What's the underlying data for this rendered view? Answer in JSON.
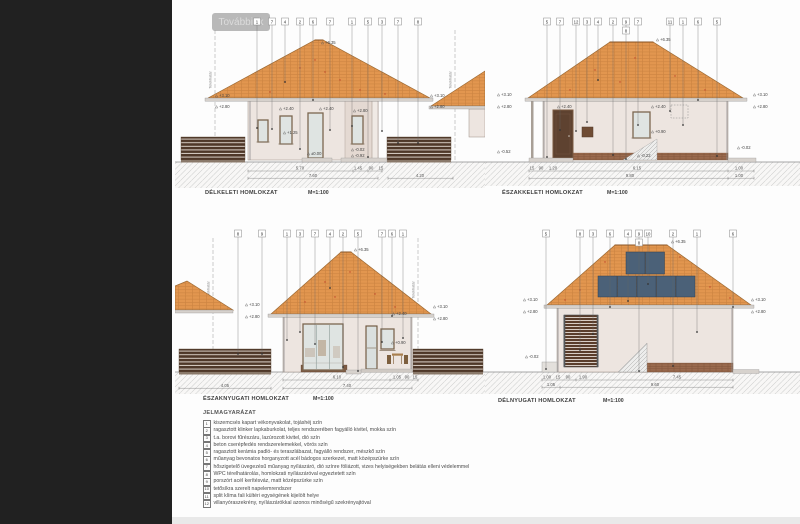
{
  "app": {
    "more_button": "Továbbiak"
  },
  "labels": {
    "boundary": "Telekhatár"
  },
  "colors": {
    "sidebar": "#212121",
    "page": "#fdfdfd",
    "roof_tile": "#e2964f",
    "wall": "#ede5e0",
    "fence_wood": "#4e3728",
    "klinker_plinth": "#9a6a4e",
    "solar_panel": "#4b6178",
    "ground_hatch": "#cdcdcd",
    "accent_red": "#c0452a"
  },
  "elevations": {
    "d1": {
      "title": "DÉLKELETI HOMLOKZAT",
      "scale": "M=1:100",
      "markers": [
        {
          "v": "1",
          "x": 82,
          "drop": 118
        },
        {
          "v": "7",
          "x": 97,
          "drop": 119
        },
        {
          "v": "4",
          "x": 110,
          "drop": 72
        },
        {
          "v": "2",
          "x": 125,
          "drop": 139
        },
        {
          "v": "6",
          "x": 138,
          "drop": 90
        },
        {
          "v": "7",
          "x": 155,
          "drop": 120
        },
        {
          "v": "1",
          "x": 177,
          "drop": 116
        },
        {
          "v": "5",
          "x": 193,
          "drop": 147
        },
        {
          "v": "3",
          "x": 207,
          "drop": 121
        },
        {
          "v": "7",
          "x": 223,
          "drop": 133
        },
        {
          "v": "8",
          "x": 243,
          "drop": 133
        }
      ],
      "levels": [
        {
          "v": "+6.35",
          "x": 150,
          "y": 34
        },
        {
          "v": "+3.10",
          "x": 44,
          "y": 87
        },
        {
          "v": "+2.80",
          "x": 44,
          "y": 98
        },
        {
          "v": "+2.40",
          "x": 108,
          "y": 100
        },
        {
          "v": "+2.40",
          "x": 148,
          "y": 100
        },
        {
          "v": "+2.80",
          "x": 182,
          "y": 102
        },
        {
          "v": "+1.25",
          "x": 112,
          "y": 124
        },
        {
          "v": "±0.00",
          "x": 136,
          "y": 145
        },
        {
          "v": "-0.02",
          "x": 180,
          "y": 141
        },
        {
          "v": "-0.92",
          "x": 180,
          "y": 147
        },
        {
          "v": "+3.10",
          "x": 259,
          "y": 87
        },
        {
          "v": "+2.80",
          "x": 259,
          "y": 98
        }
      ],
      "dims": [
        {
          "v": "5.70",
          "x": 125,
          "y": 159.5
        },
        {
          "v": "1.45",
          "x": 183,
          "y": 159.5
        },
        {
          "v": "90",
          "x": 196,
          "y": 159.5
        },
        {
          "v": "15",
          "x": 206,
          "y": 159.5
        },
        {
          "v": "7.60",
          "x": 138,
          "y": 166.8
        },
        {
          "v": "4.20",
          "x": 245,
          "y": 166.8
        }
      ]
    },
    "d2": {
      "title": "ÉSZAKKELETI HOMLOKZAT",
      "scale": "M=1:100",
      "markers": [
        {
          "v": "5",
          "x": 62,
          "drop": 147
        },
        {
          "v": "7",
          "x": 75,
          "drop": 120
        },
        {
          "v": "12",
          "x": 91,
          "drop": 121
        },
        {
          "v": "3",
          "x": 102,
          "drop": 112
        },
        {
          "v": "4",
          "x": 113,
          "drop": 70
        },
        {
          "v": "2",
          "x": 128,
          "drop": 145
        },
        {
          "v": "9",
          "x": 141,
          "drop": 149
        },
        {
          "v": "8",
          "x": 141,
          "y": 17
        },
        {
          "v": "7",
          "x": 153,
          "drop": 115
        },
        {
          "v": "11",
          "x": 185,
          "drop": 101
        },
        {
          "v": "1",
          "x": 198,
          "drop": 115
        },
        {
          "v": "6",
          "x": 213,
          "drop": 90
        },
        {
          "v": "5",
          "x": 232,
          "drop": 146
        }
      ],
      "levels": [
        {
          "v": "+6.35",
          "x": 175,
          "y": 31
        },
        {
          "v": "+3.10",
          "x": 16,
          "y": 86
        },
        {
          "v": "+2.80",
          "x": 16,
          "y": 98
        },
        {
          "v": "+2.40",
          "x": 76,
          "y": 98
        },
        {
          "v": "+2.40",
          "x": 170,
          "y": 98
        },
        {
          "v": "+0.90",
          "x": 170,
          "y": 123
        },
        {
          "v": "-0.52",
          "x": 16,
          "y": 143
        },
        {
          "v": "-0.22",
          "x": 156,
          "y": 147
        },
        {
          "v": "-0.02",
          "x": 256,
          "y": 139
        },
        {
          "v": "+3.10",
          "x": 272,
          "y": 86
        },
        {
          "v": "+2.80",
          "x": 272,
          "y": 98
        }
      ],
      "dims": [
        {
          "v": "15",
          "x": 47,
          "y": 159.5
        },
        {
          "v": "90",
          "x": 56,
          "y": 159.5
        },
        {
          "v": "1.20",
          "x": 68,
          "y": 159.5
        },
        {
          "v": "6.15",
          "x": 152,
          "y": 159.5
        },
        {
          "v": "1.00",
          "x": 254,
          "y": 159.5
        },
        {
          "v": "9.80",
          "x": 145,
          "y": 166.8
        },
        {
          "v": "1.00",
          "x": 254,
          "y": 166.8
        }
      ]
    },
    "d3": {
      "title": "ÉSZAKNYUGATI HOMLOKZAT",
      "scale": "M=1:100",
      "markers": [
        {
          "v": "8",
          "x": 63,
          "drop": 132
        },
        {
          "v": "9",
          "x": 87,
          "drop": 132
        },
        {
          "v": "1",
          "x": 112,
          "drop": 118
        },
        {
          "v": "3",
          "x": 125,
          "drop": 110
        },
        {
          "v": "7",
          "x": 140,
          "drop": 122
        },
        {
          "v": "4",
          "x": 155,
          "drop": 66
        },
        {
          "v": "2",
          "x": 168,
          "drop": 145
        },
        {
          "v": "5",
          "x": 183,
          "drop": 149
        },
        {
          "v": "7",
          "x": 207,
          "drop": 120
        },
        {
          "v": "6",
          "x": 217,
          "drop": 94
        },
        {
          "v": "1",
          "x": 228,
          "drop": 116
        }
      ],
      "levels": [
        {
          "v": "+6.35",
          "x": 183,
          "y": 29
        },
        {
          "v": "+3.10",
          "x": 74,
          "y": 84
        },
        {
          "v": "+2.80",
          "x": 74,
          "y": 96
        },
        {
          "v": "+2.40",
          "x": 221,
          "y": 93
        },
        {
          "v": "+0.90",
          "x": 220,
          "y": 122
        },
        {
          "v": "+3.10",
          "x": 262,
          "y": 86
        },
        {
          "v": "+2.80",
          "x": 262,
          "y": 98
        }
      ],
      "dims": [
        {
          "v": "6.10",
          "x": 162,
          "y": 156.5
        },
        {
          "v": "1.05",
          "x": 222,
          "y": 156.5
        },
        {
          "v": "90",
          "x": 232,
          "y": 156.5
        },
        {
          "v": "15",
          "x": 240,
          "y": 156.5
        },
        {
          "v": "4.05",
          "x": 50,
          "y": 164.8
        },
        {
          "v": "7.40",
          "x": 172,
          "y": 164.8
        }
      ]
    },
    "d4": {
      "title": "DÉLNYUGATI HOMLOKZAT",
      "scale": "M=1:100",
      "markers": [
        {
          "v": "5",
          "x": 61,
          "drop": 147
        },
        {
          "v": "8",
          "x": 95,
          "drop": 128
        },
        {
          "v": "3",
          "x": 108,
          "drop": 112
        },
        {
          "v": "6",
          "x": 125,
          "drop": 85
        },
        {
          "v": "4",
          "x": 143,
          "drop": 79
        },
        {
          "v": "9",
          "x": 154,
          "drop": 149
        },
        {
          "v": "8",
          "x": 154,
          "y": 17
        },
        {
          "v": "10",
          "x": 163,
          "drop": 62
        },
        {
          "v": "2",
          "x": 188,
          "drop": 144
        },
        {
          "v": "1",
          "x": 212,
          "drop": 110
        },
        {
          "v": "6",
          "x": 248,
          "drop": 85
        }
      ],
      "levels": [
        {
          "v": "+6.35",
          "x": 190,
          "y": 21
        },
        {
          "v": "+3.10",
          "x": 42,
          "y": 79
        },
        {
          "v": "+2.80",
          "x": 42,
          "y": 91
        },
        {
          "v": "-0.02",
          "x": 44,
          "y": 136
        },
        {
          "v": "+3.10",
          "x": 270,
          "y": 79
        },
        {
          "v": "+2.80",
          "x": 270,
          "y": 91
        }
      ],
      "dims": [
        {
          "v": "1.00",
          "x": 62,
          "y": 156.5
        },
        {
          "v": "15",
          "x": 73,
          "y": 156.5
        },
        {
          "v": "90",
          "x": 83,
          "y": 156.5
        },
        {
          "v": "1.90",
          "x": 98,
          "y": 156.5
        },
        {
          "v": "7.45",
          "x": 192,
          "y": 156.5
        },
        {
          "v": "1.05",
          "x": 66,
          "y": 163.8
        },
        {
          "v": "9.60",
          "x": 170,
          "y": 163.8
        }
      ]
    }
  },
  "legend": {
    "title": "JELMAGYARÁZAT",
    "items": [
      {
        "num": "1",
        "text": "kiszemcsés kapart vékonyvakolat, tojáshéj szín"
      },
      {
        "num": "2",
        "text": "ragasztott klinker lapkaburkolat, teljes rendszerében fagyálló kivitel, mokka szín"
      },
      {
        "num": "3",
        "text": "t.a. borovi fűrészáru, lazúrozott kivitel, dió szín"
      },
      {
        "num": "4",
        "text": "beton cserépfedés rendszerelemekkel, vörös szín"
      },
      {
        "num": "5",
        "text": "ragasztott kerámia padló- és teraszlábazat, fagyálló rendszer, mészkő szín"
      },
      {
        "num": "6",
        "text": "műanyag bevonatos horganyzott acél bádogos szerkezet, matt középszürke szín"
      },
      {
        "num": "7",
        "text": "hőszigetelő üvegezésű műanyag nyílászáró, dió színre fóliázott, vizes helyiségekben belátás elleni védelemmel"
      },
      {
        "num": "8",
        "text": "WPC térelhatárolás, homlokzati nyílászáróval egyeztetett szín"
      },
      {
        "num": "9",
        "text": "porszórt acél kerítésváz, matt középszürke szín"
      },
      {
        "num": "10",
        "text": "tetősíkra szerelt napelemrendszer"
      },
      {
        "num": "11",
        "text": "split klíma fali kültéri egységének kijelölt helye"
      },
      {
        "num": "12",
        "text": "villanyóraszekrény, nyílászárókkal azonos minőségű szekrényajtóval"
      }
    ]
  }
}
